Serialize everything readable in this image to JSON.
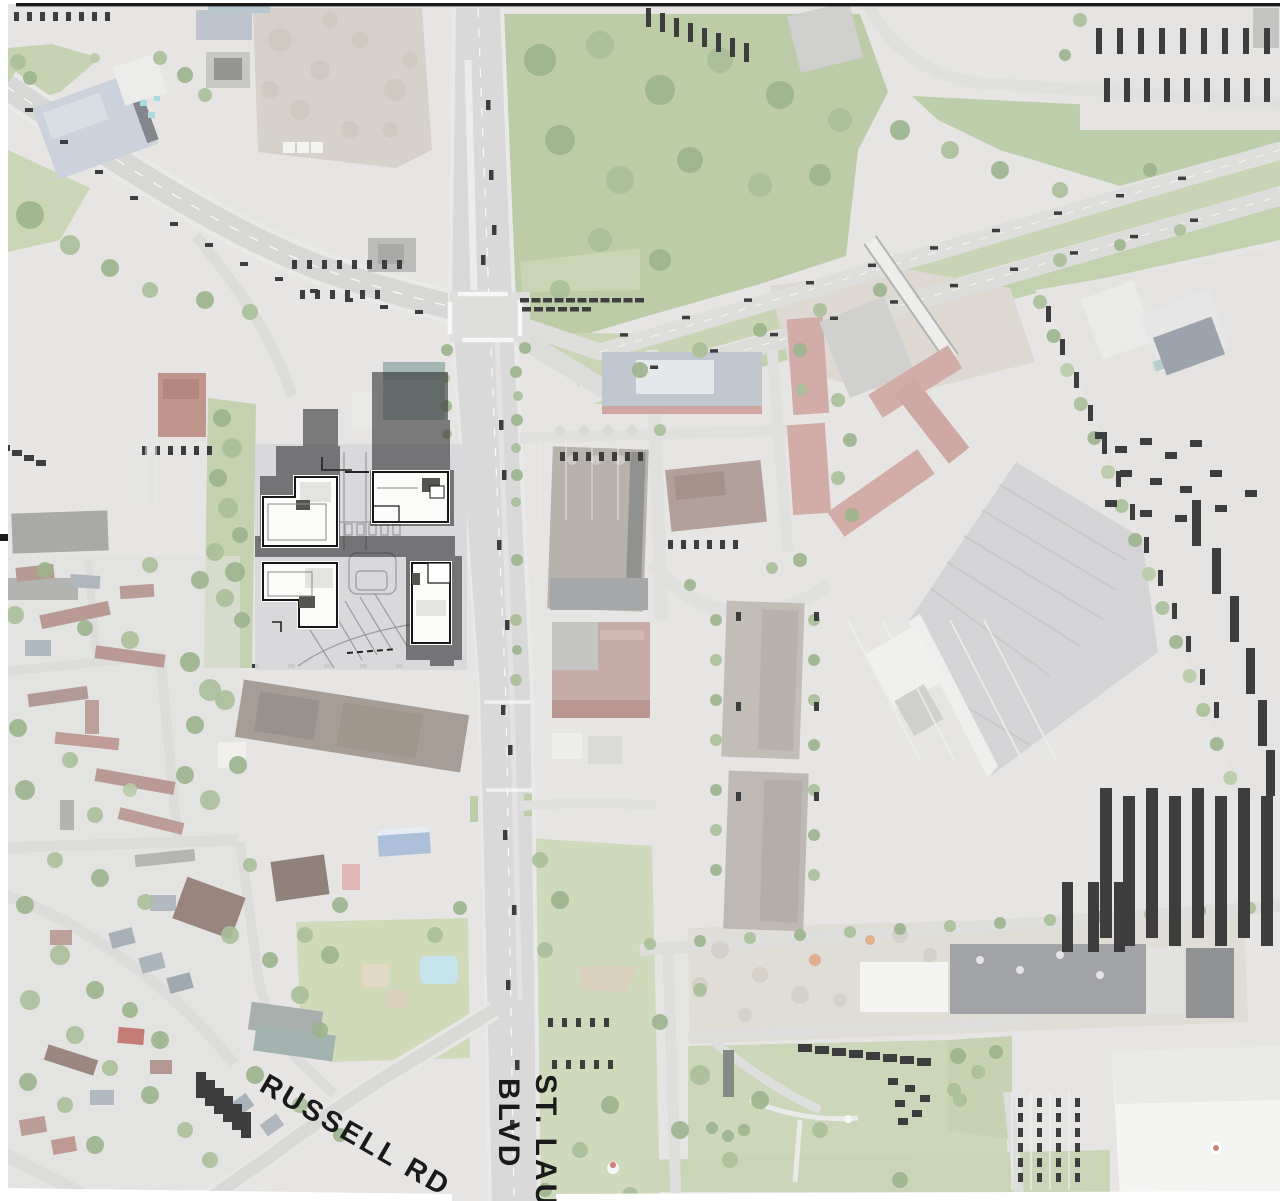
{
  "map": {
    "kind": "aerial-site-context-map",
    "labels": {
      "russell_rd": "RUSSELL RD",
      "st_laurent_line1": "ST. LAUR",
      "st_laurent_line2": "BLVD"
    },
    "palette": {
      "label_text": "#1a1a1a",
      "photo_base": "#dedddb",
      "road": "#cecece",
      "grass": "#bcc9a0",
      "forest": "#8fab79",
      "red_roof": "#c4938c",
      "brown_roof": "#a47a72",
      "warehouse_roof": "#c7c7c9",
      "overlay_shadow": "#232326",
      "site_base": "#d8d8db",
      "building_footprint": "#fbfbfa",
      "footprint_outline": "#161616",
      "pool": "#b5dce8",
      "photo_border": "#1b1b1b",
      "margin": "#ffffff"
    }
  }
}
